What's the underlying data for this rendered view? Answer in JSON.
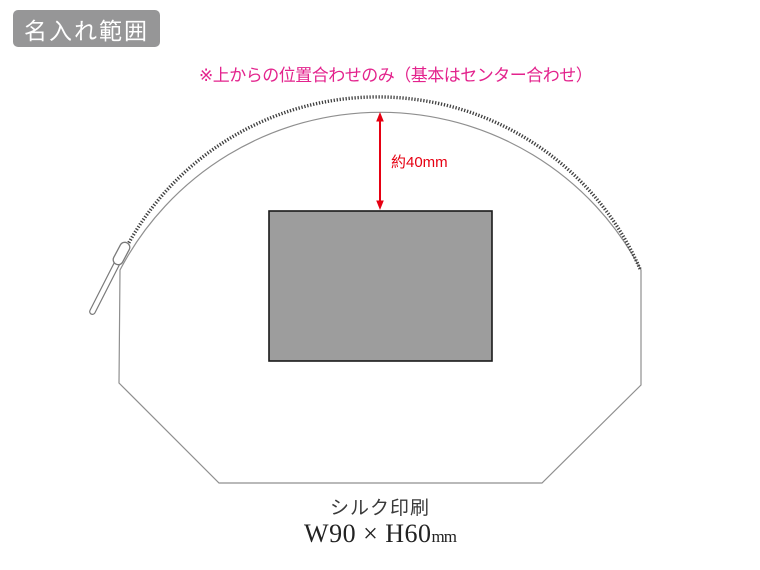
{
  "badge": {
    "label": "名入れ範囲",
    "bg_color": "#969697",
    "text_color": "#ffffff"
  },
  "note": {
    "text": "※上からの位置合わせのみ（基本はセンター合わせ）",
    "color": "#e3238d"
  },
  "diagram": {
    "dimension_label": "約40mm",
    "dimension_color": "#e60012",
    "print_area_fill": "#9d9d9d",
    "print_area_border": "#1a1a1a",
    "outline_color": "#8f8f8f",
    "zipper_color": "#3f3f3f",
    "hardware_color": "#7a7a7a",
    "shapes": [
      "pouch-outline",
      "zipper-teeth",
      "zipper-slider",
      "zipper-pull-tab",
      "print-area-rect",
      "dimension-arrow"
    ]
  },
  "caption": {
    "method": "シルク印刷",
    "size_value": "W90 × H60",
    "size_unit": "mm"
  }
}
